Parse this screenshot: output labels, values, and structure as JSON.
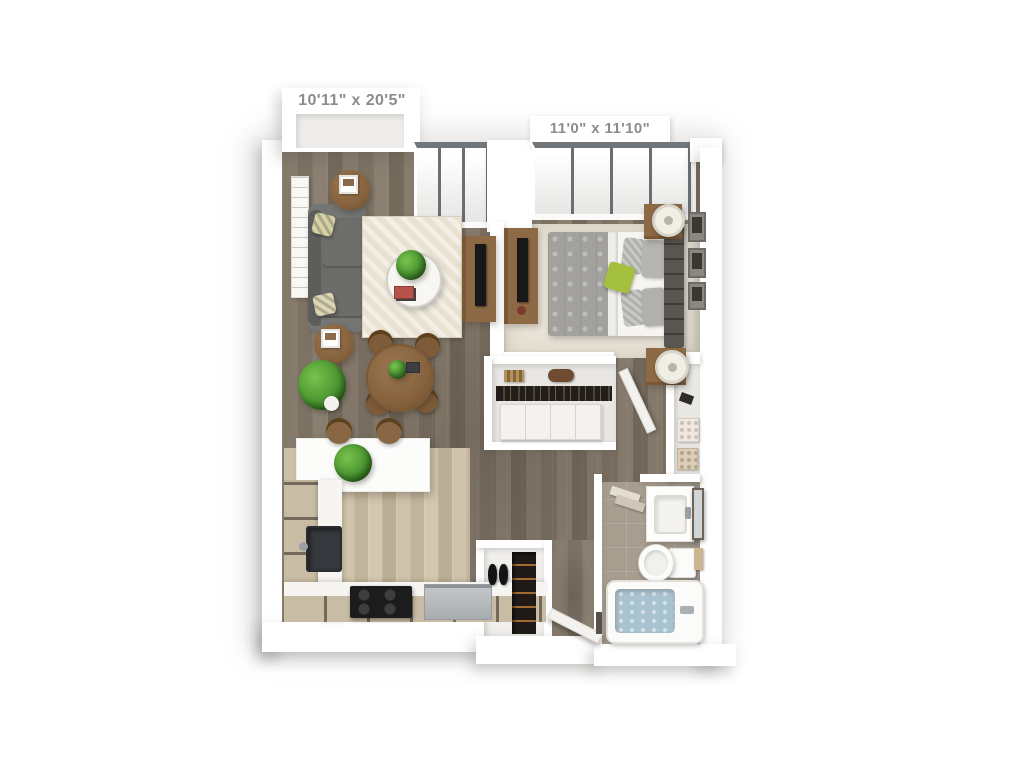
{
  "meta": {
    "description": "3D rendered top-down floor plan of a one-bedroom apartment",
    "background_color": "#ffffff"
  },
  "labels": {
    "living": "10'11\" x 20'5\"",
    "bedroom": "11'0\" x 11'10\""
  },
  "palette": {
    "wall": "#ffffff",
    "wood_floor": "#85796b",
    "kitchen_floor": "#ccc0a8",
    "bedroom_carpet": "#eae4d8",
    "bathroom_tile": "#a89e90",
    "counter_cabinet": "#c8bca5",
    "sofa_gray": "#696967",
    "furniture_wood": "#8d6a45",
    "tv_black": "#181818",
    "accent_green": "#a5c03f",
    "plant_green": "#4a9630",
    "tub_water": "#a9c2cf",
    "label_text": "#8c8c8c",
    "window_mullion": "#6a6f73"
  },
  "rooms": {
    "living_room": {
      "name": "Living / Dining Room",
      "dimensions": "10'11\" x 20'5\"",
      "items": [
        "sofa",
        "throw-pillows",
        "wall-art",
        "round-side-tables",
        "picture-frames",
        "area-rug",
        "glass-coffee-table",
        "potted-plant",
        "books",
        "tv-console",
        "dining-table",
        "dining-chairs",
        "floor-plant"
      ]
    },
    "bedroom": {
      "name": "Bedroom",
      "dimensions": "11'0\" x 11'10\"",
      "items": [
        "bed",
        "gray-duvet",
        "pillows",
        "green-accent-pillow",
        "upholstered-headboard",
        "nightstands",
        "table-lamps",
        "media-console",
        "wall-frames",
        "floor-to-ceiling-windows"
      ]
    },
    "closet": {
      "name": "Closet",
      "items": [
        "shelf-basket",
        "rolled-blanket",
        "hanging-clothes",
        "drawer-unit"
      ]
    },
    "hallway": {
      "name": "Hallway",
      "items": [
        "bedroom-door",
        "linen-shelving",
        "storage-baskets"
      ]
    },
    "bathroom": {
      "name": "Bathroom",
      "items": [
        "towel-bar",
        "vanity-sink",
        "framed-mirror",
        "toilet",
        "hand-towel",
        "bathtub"
      ]
    },
    "kitchen": {
      "name": "Kitchen",
      "items": [
        "breakfast-bar",
        "bar-stools",
        "herb-plant",
        "cabinets",
        "kitchen-sink",
        "cooktop",
        "dishwasher"
      ]
    },
    "entry": {
      "name": "Entry",
      "items": [
        "entry-door",
        "shoe-closet",
        "shoes",
        "shoe-rack"
      ]
    }
  }
}
